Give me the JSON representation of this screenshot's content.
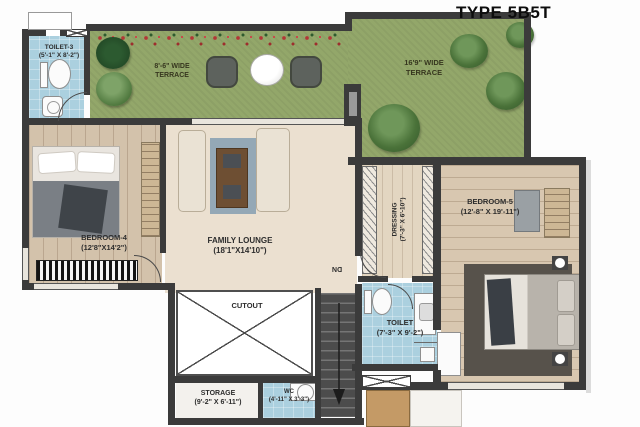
{
  "title": "TYPE 5B5T",
  "rooms": {
    "toilet3": {
      "lines": [
        "TOILET-3",
        "(5'-1\" X 8'-2\")"
      ]
    },
    "terrace_left": {
      "lines": [
        "8'-6\" WIDE",
        "TERRACE"
      ]
    },
    "terrace_right": {
      "lines": [
        "16'9\" WIDE",
        "TERRACE"
      ]
    },
    "bedroom4": {
      "lines": [
        "BEDROOM-4",
        "(12'8\"X14'2\")"
      ]
    },
    "family_lounge": {
      "lines": [
        "FAMILY LOUNGE",
        "(18'1\"X14'10\")"
      ]
    },
    "bedroom5": {
      "lines": [
        "BEDROOM-5",
        "(12'-8\" X 19'-11\")"
      ]
    },
    "dressing": {
      "lines": [
        "DRESSING",
        "(7'-3\" X 6'-10\")"
      ]
    },
    "toilet": {
      "lines": [
        "TOILET",
        "(7'-3\" X 9'-2\")"
      ]
    },
    "cutout": {
      "lines": [
        "CUTOUT"
      ]
    },
    "storage": {
      "lines": [
        "STORAGE",
        "(9'-2\" X 6'-11\")"
      ]
    },
    "wc": {
      "lines": [
        "WC",
        "(4'-11\" X 3'-3\")"
      ]
    }
  },
  "stairs": {
    "direction_label": "DN"
  },
  "colors": {
    "wall": "#3b3b3b",
    "grass": "#93a76a",
    "floor_beige": "#ebe0d0",
    "floor_wood": "#d3c2ab",
    "toilet_blue": "#abd0df",
    "flower_red": "#b23636",
    "title_text": "#111111"
  }
}
